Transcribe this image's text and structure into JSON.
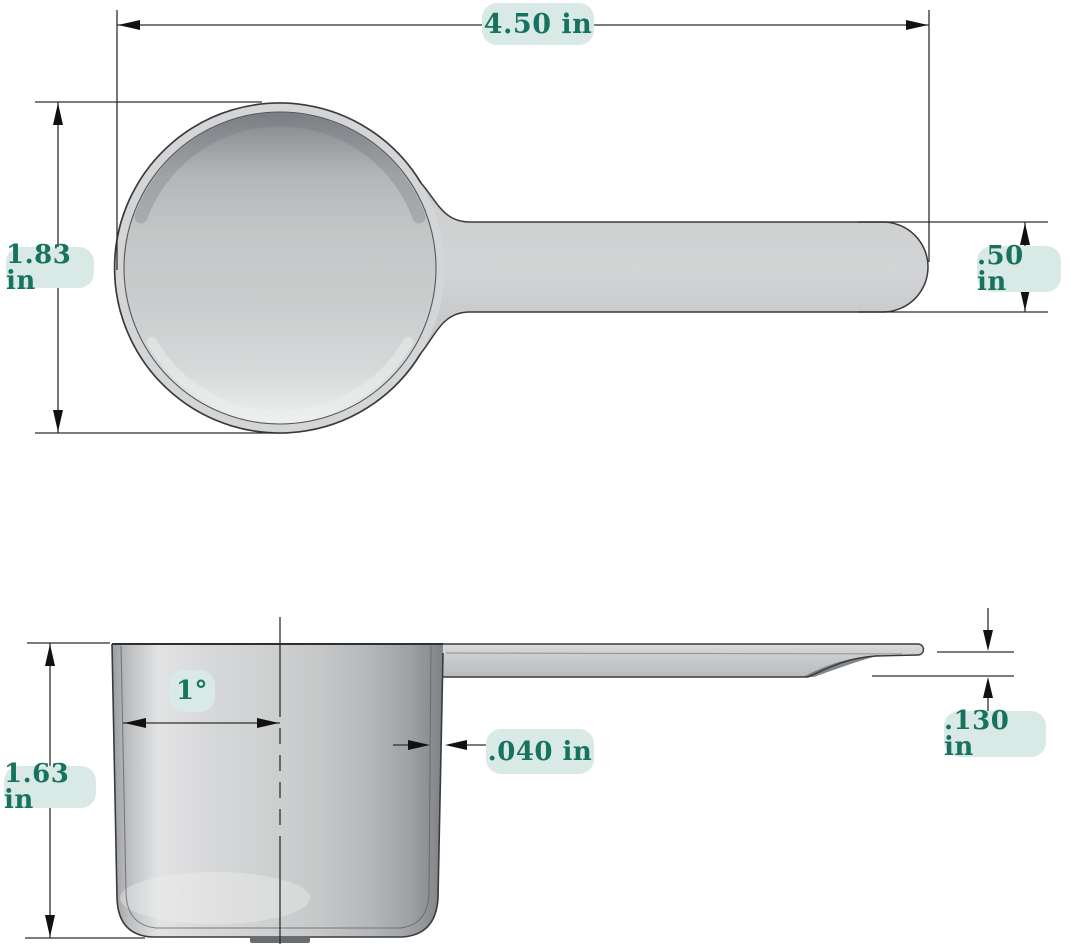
{
  "drawing": {
    "subject": "measuring-scoop",
    "views": {
      "top_view": {
        "dimensions": {
          "overall_length": "4.50 in",
          "bowl_diameter": "1.83 in",
          "handle_width": ".50 in"
        }
      },
      "side_view": {
        "dimensions": {
          "bowl_depth": "1.63 in",
          "draft_angle": "1°",
          "wall_thickness": ".040 in",
          "handle_thickness": ".130 in"
        }
      }
    },
    "colors": {
      "label_background": "#d9eae6",
      "label_text": "#17735f",
      "line_color": "#2e2e2e",
      "body_fill": "#cdcfd0",
      "page_background": "#ffffff"
    }
  }
}
